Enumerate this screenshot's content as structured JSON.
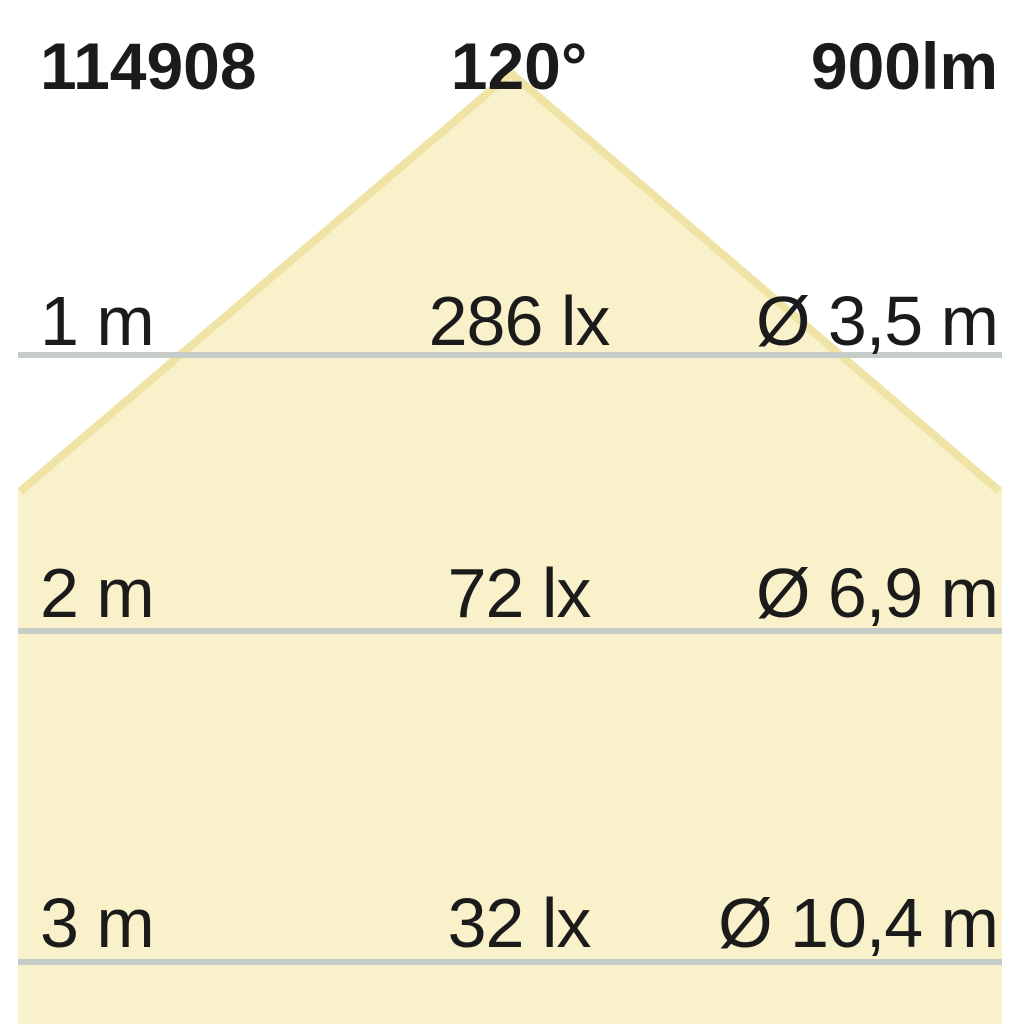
{
  "header": {
    "article_number": "114908",
    "beam_angle": "120°",
    "luminous_flux": "900lm"
  },
  "rows": [
    {
      "distance": "1 m",
      "illuminance": "286 lx",
      "beam_diameter": "Ø 3,5 m"
    },
    {
      "distance": "2 m",
      "illuminance": "72 lx",
      "beam_diameter": "Ø 6,9 m"
    },
    {
      "distance": "3 m",
      "illuminance": "32 lx",
      "beam_diameter": "Ø 10,4 m"
    }
  ],
  "colors": {
    "beam_fill": "#f8f1ca",
    "beam_edge": "#efe4a6",
    "separator_line": "#c6cdc9",
    "text": "#1b1b1b",
    "background": "#ffffff"
  }
}
